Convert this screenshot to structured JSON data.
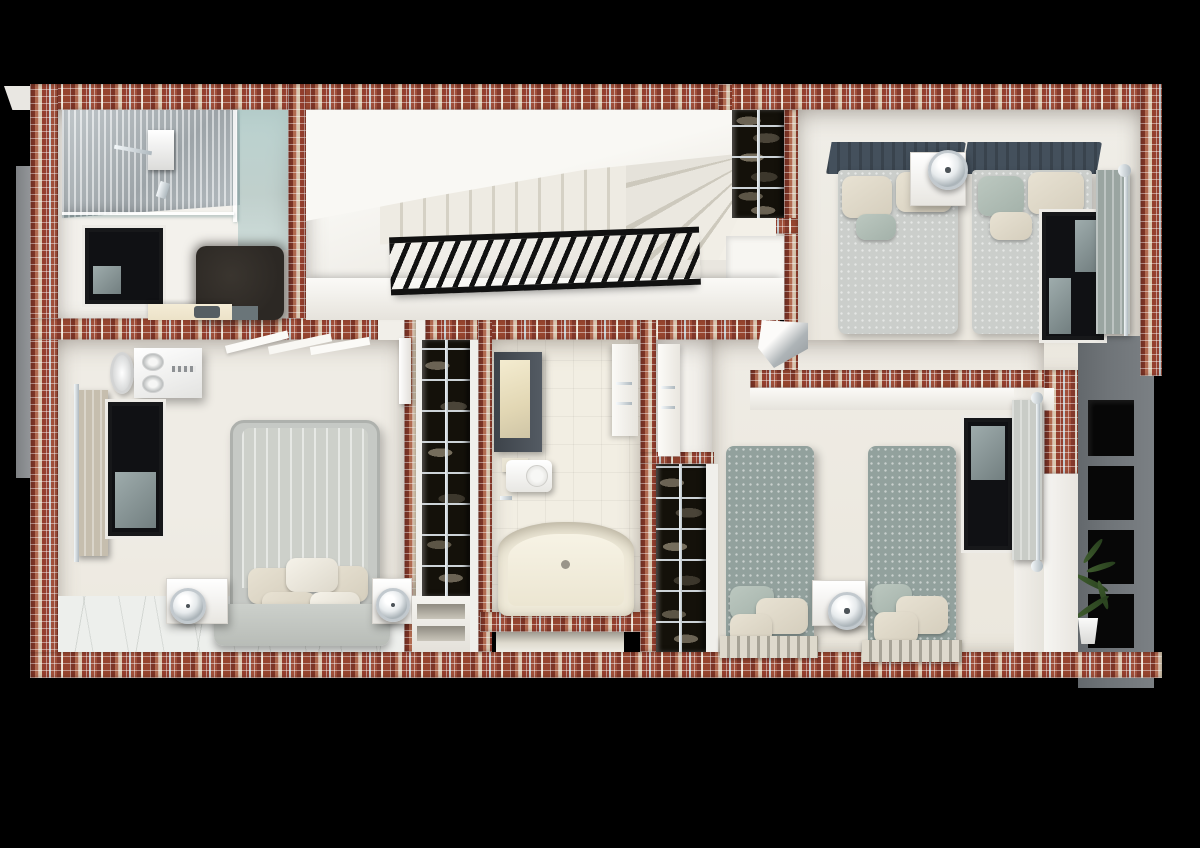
{
  "scene": {
    "type": "3d-floor-plan-render",
    "view": "top-down dollhouse cutaway of an upper residential floor",
    "background": "#000000"
  },
  "palette": {
    "bg": "#000000",
    "mosaic-base": "#9b4c39",
    "mosaic-dark": "#7c3426",
    "mosaic-light": "#d9c8b0",
    "mosaic-silver": "#c5ccd0",
    "room-white": "#f3f1ec",
    "floor-cream": "#ece8de",
    "floor-marble": "#edefec",
    "ceiling-white": "#f8f7f3",
    "railing": "#111111",
    "window-frame": "#17181a",
    "glass-blue": "#b0cdcb",
    "shower-silver": "#bcc2c5",
    "tub-cream": "#efead9",
    "vanity-cream": "#ece2c8",
    "rug-dark": "#2c2824",
    "closet-dark": "#14110a",
    "chrome": "#d6dde2",
    "headboard-slate": "#44505c",
    "mattress-gray": "#cbcecb",
    "bed-master-gray": "#c6c9c5",
    "bed-kids-sage": "#92a19d",
    "pillow-beige": "#d5cebd",
    "pillow-sage": "#a3b1a9",
    "curtain-gray": "#9aa5a1",
    "curtain-light": "#c9ccc7",
    "curtain-beige": "#c6beae",
    "planter-gray": "#6f7478",
    "niche-black": "#070707",
    "plant-green": "#3f5c2e",
    "ac-white": "#f6f6f5"
  },
  "rooms": [
    {
      "id": "ensuite-bathroom-top-left",
      "furniture": [
        "walk-in-shower",
        "shower-glass-screen",
        "window",
        "bath-rug",
        "vanity-counter"
      ]
    },
    {
      "id": "staircase-hall",
      "furniture": [
        "straight-stair-run",
        "winder-steps",
        "black-stair-railing",
        "landing"
      ]
    },
    {
      "id": "linen-closet-top",
      "furniture": [
        "wire-shelving-with-clothes",
        "center-pole"
      ]
    },
    {
      "id": "bedroom-top-right",
      "furniture": [
        "single-bed",
        "single-bed",
        "shared-nightstand",
        "globe-lamp",
        "window",
        "curtain-panel"
      ]
    },
    {
      "id": "master-bedroom",
      "furniture": [
        "platform-double-bed",
        "pillows",
        "nightstand-left",
        "nightstand-right",
        "table-lamp",
        "table-lamp",
        "ac-unit",
        "ceiling-fan-vent",
        "window",
        "curtain-panel",
        "marble-floor",
        "ceiling-beams",
        "open-door-leaf"
      ]
    },
    {
      "id": "walk-in-wardrobe-column",
      "furniture": [
        "wire-shelving-with-clothes",
        "center-pole",
        "open-shoe-cubbies"
      ]
    },
    {
      "id": "family-bathroom-center",
      "furniture": [
        "bathtub",
        "toilet",
        "mirror-cabinet",
        "towel-column",
        "wall-hooks"
      ]
    },
    {
      "id": "hall-shoe-closet",
      "furniture": [
        "wire-shelving-with-shoes",
        "center-pole"
      ]
    },
    {
      "id": "corner-wash-basin",
      "furniture": [
        "corner-unit"
      ]
    },
    {
      "id": "bedroom-bottom-right",
      "furniture": [
        "single-bed",
        "single-bed",
        "shared-nightstand",
        "globe-lamp",
        "window",
        "curtain-panel",
        "slatted-bed-bases"
      ]
    },
    {
      "id": "exterior-planter-wall",
      "furniture": [
        "niche",
        "niche",
        "niche",
        "niche",
        "potted-plant"
      ]
    }
  ]
}
